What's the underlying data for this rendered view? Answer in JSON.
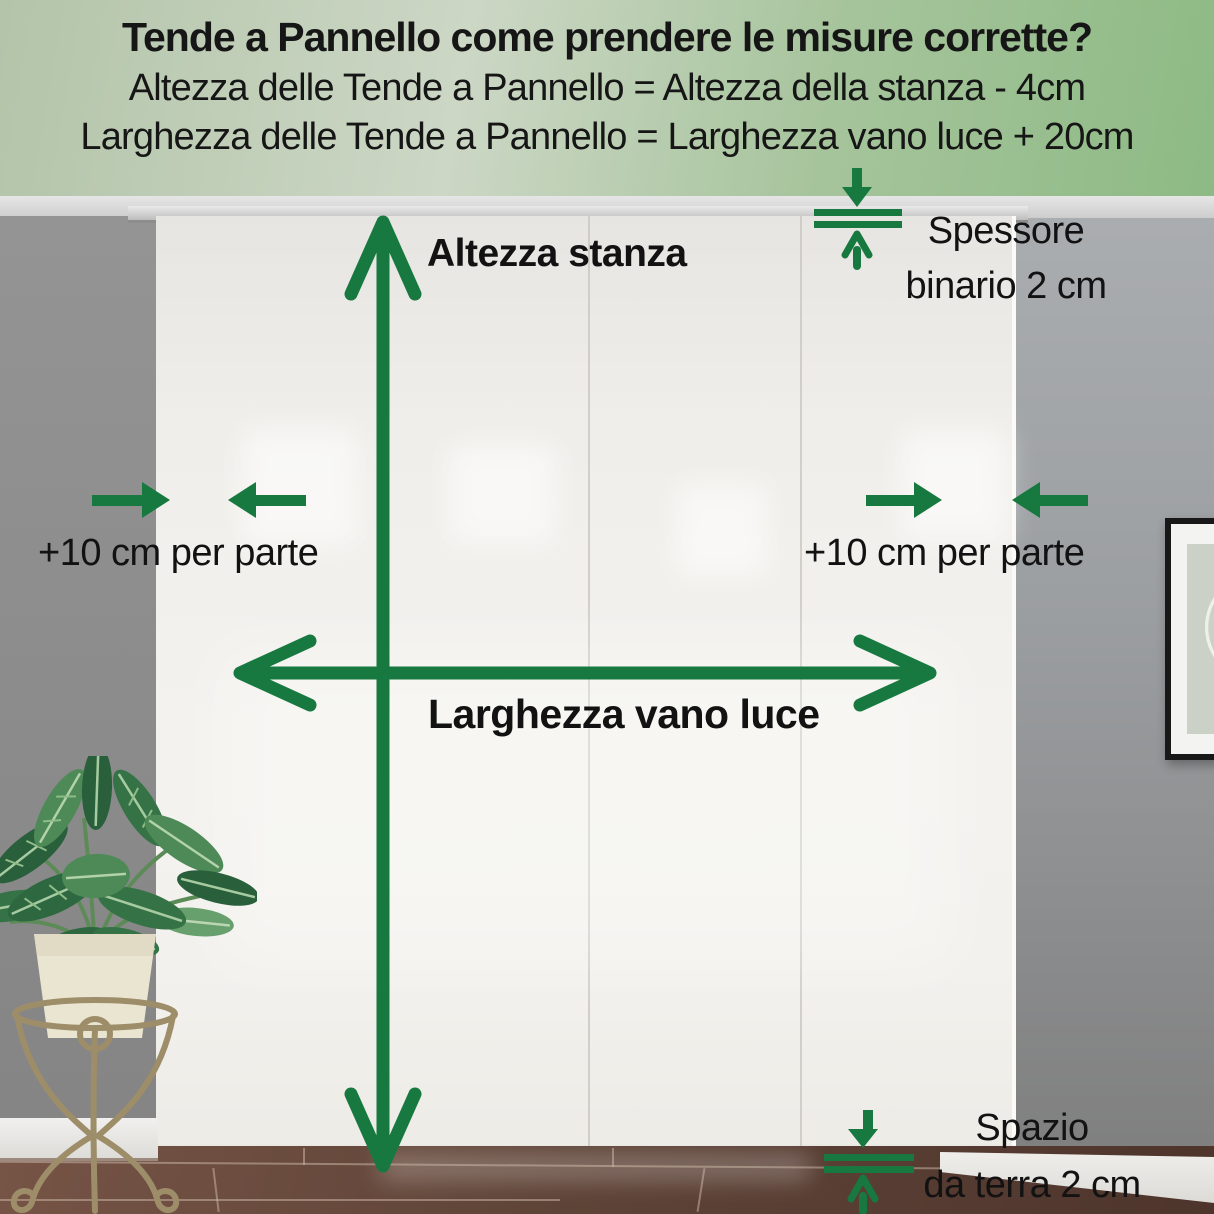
{
  "header": {
    "title": "Tende a Pannello come prendere le misure corrette?",
    "formula_height": "Altezza delle Tende a Pannello = Altezza della stanza - 4cm",
    "formula_width": "Larghezza delle Tende a Pannello = Larghezza vano luce + 20cm"
  },
  "labels": {
    "room_height": "Altezza stanza",
    "opening_width": "Larghezza vano luce",
    "side_allowance_left": "+10 cm per parte",
    "side_allowance_right": "+10 cm per parte",
    "rail_thickness_line1": "Spessore",
    "rail_thickness_line2": "binario 2 cm",
    "floor_gap_line1": "Spazio",
    "floor_gap_line2": "da terra 2 cm"
  },
  "colors": {
    "arrow_green": "#17793f",
    "header_green_left": "#b3c4a9",
    "header_green_right": "#8dba84",
    "wall_gray": "#8a8a8a",
    "curtain_white": "#f2f0ec",
    "floor_brown": "#5d4238",
    "baseboard_white": "#e9e7e2",
    "text_black": "#161616"
  }
}
